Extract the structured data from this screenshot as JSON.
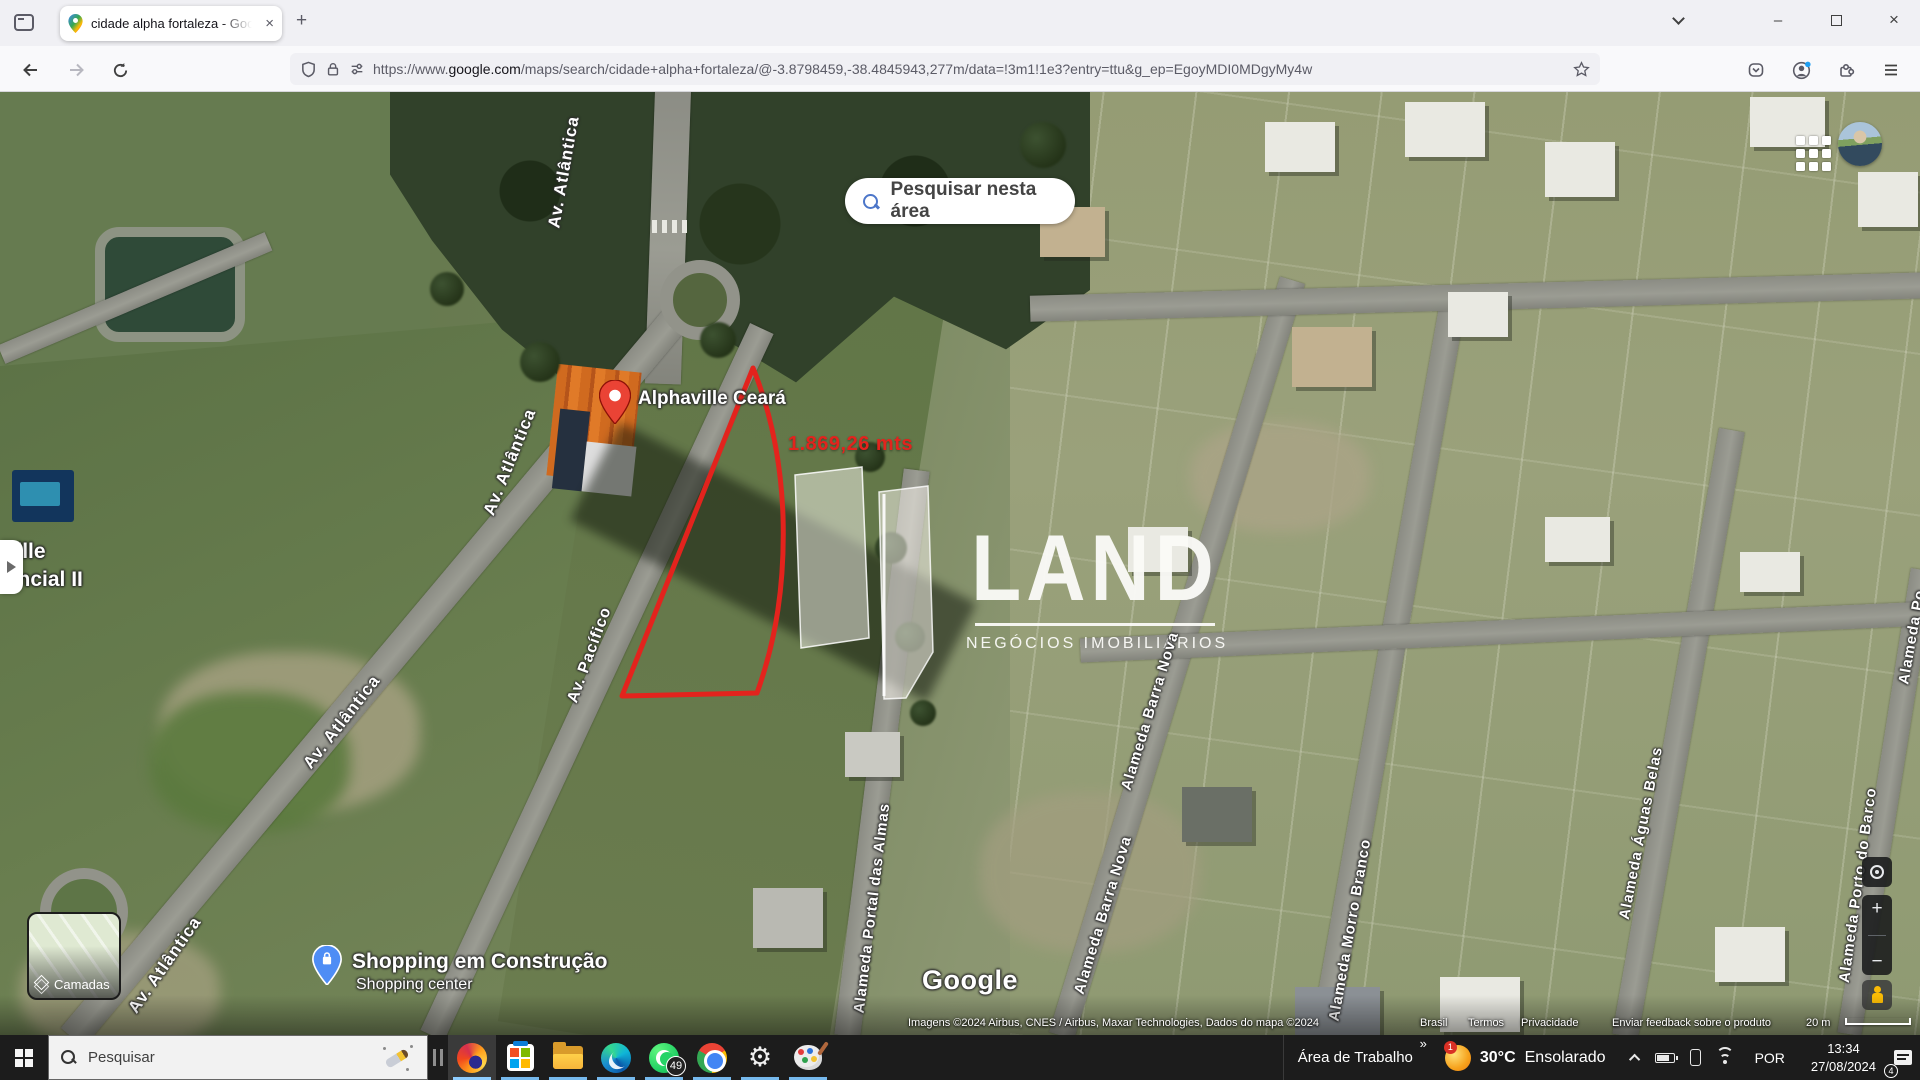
{
  "browser": {
    "tab_title": "cidade alpha fortaleza - Googl",
    "url_protocol": "https://www.",
    "url_domain": "google.com",
    "url_path": "/maps/search/cidade+alpha+fortaleza/@-3.8798459,-38.4845943,277m/data=!3m1!1e3?entry=ttu&g_ep=EgoyMDI0MDgyMy4w"
  },
  "glyphs": {
    "close": "×",
    "new_tab": "+",
    "minimize": "–",
    "chevron_double": "»",
    "gear": "⚙"
  },
  "map": {
    "search_area_button": "Pesquisar nesta área",
    "marker_label": "Alphaville Ceará",
    "measurement_label": "1.869,26 mts",
    "watermark_title": "LAND",
    "watermark_subtitle": "NEGÓCIOS IMOBILIÁRIOS",
    "panel_text_line1": "aville",
    "panel_text_line2": "dencial II",
    "streets": {
      "atlantica_top": "Av. Atlântica",
      "atlantica_mid": "Av. Atlântica",
      "atlantica_low": "Av. Atlântica",
      "atlantica_bottom": "Av. Atlântica",
      "pacifico": "Av. Pacífico",
      "portal_das_almas": "Alameda Portal das Almas",
      "barra_nova_1": "Alameda Barra Nova",
      "barra_nova_2": "Alameda Barra Nova",
      "morro_branco": "Alameda Morro Branco",
      "aguas_belas": "Alameda Águas Belas",
      "porto_do_barco": "Alameda Porto do Barco",
      "alameda_edge": "Alameda Po"
    },
    "shopping_title": "Shopping em Construção",
    "shopping_subtitle": "Shopping center",
    "google_logo": "Google",
    "layers_button": "Camadas",
    "zoom_in": "+",
    "zoom_out": "−",
    "attribution": {
      "imagery": "Imagens ©2024 Airbus, CNES / Airbus, Maxar Technologies, Dados do mapa ©2024",
      "link_brasil": "Brasil",
      "link_termos": "Termos",
      "link_privacidade": "Privacidade",
      "link_feedback": "Enviar feedback sobre o produto",
      "scale_label": "20 m"
    }
  },
  "taskbar": {
    "search_placeholder": "Pesquisar",
    "desktop_toolbar_label": "Área de Trabalho",
    "weather_temp": "30°C",
    "weather_condition": "Ensolarado",
    "weather_badge": "1",
    "whatsapp_badge": "49",
    "language": "POR",
    "time": "13:34",
    "date": "27/08/2024",
    "notification_badge": "4"
  }
}
